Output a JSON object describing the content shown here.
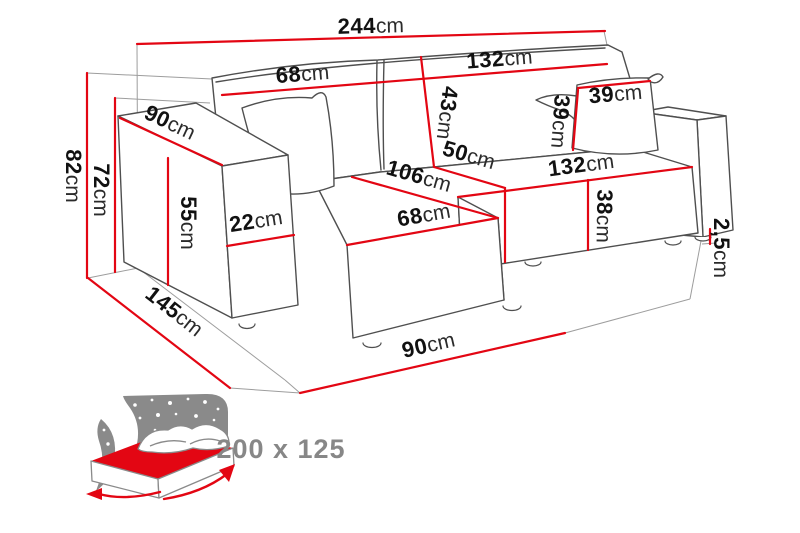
{
  "diagram": {
    "colors": {
      "dimension_red": "#e30613",
      "outline_gray": "#4f4f4f",
      "icon_gray": "#8a8a8a"
    },
    "dims": {
      "total_width": {
        "v": "244",
        "u": "cm"
      },
      "total_height": {
        "v": "82",
        "u": "cm"
      },
      "back_height": {
        "v": "72",
        "u": "cm"
      },
      "armrest_depth": {
        "v": "90",
        "u": "cm"
      },
      "armrest_height": {
        "v": "55",
        "u": "cm"
      },
      "armrest_width": {
        "v": "22",
        "u": "cm"
      },
      "backrest_left_width": {
        "v": "68",
        "u": "cm"
      },
      "backrest_height": {
        "v": "43",
        "u": "cm"
      },
      "backrest_right_width": {
        "v": "132",
        "u": "cm"
      },
      "pillow_width": {
        "v": "39",
        "u": "cm"
      },
      "pillow_height": {
        "v": "39",
        "u": "cm"
      },
      "seat_depth": {
        "v": "50",
        "u": "cm"
      },
      "chaise_length": {
        "v": "106",
        "u": "cm"
      },
      "chaise_width": {
        "v": "68",
        "u": "cm"
      },
      "seat_front_width": {
        "v": "132",
        "u": "cm"
      },
      "seat_height": {
        "v": "38",
        "u": "cm"
      },
      "leg_height": {
        "v": "2,5",
        "u": "cm"
      },
      "total_depth": {
        "v": "145",
        "u": "cm"
      },
      "chaise_footprint": {
        "v": "90",
        "u": "cm"
      }
    },
    "sleeping_area": {
      "label": "200 x 125"
    }
  }
}
